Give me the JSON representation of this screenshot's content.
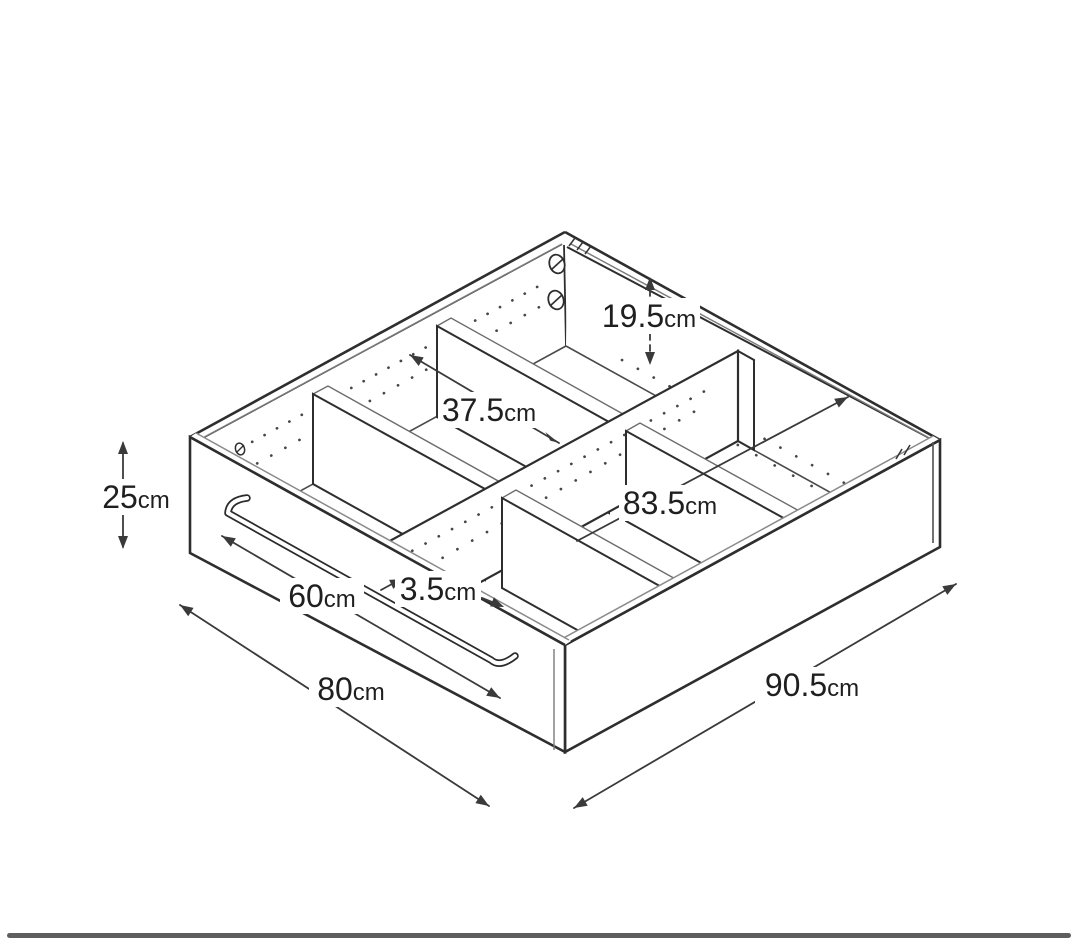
{
  "figure": {
    "type": "isometric line drawing",
    "subject": "drawer storage box with central divider, four cross dividers (six compartments), rod handle, screw fittings and shelf-pin hole rows",
    "line_color": "#2e2e2e",
    "secondary_line_color": "#8a8a8a",
    "dimension_color": "#3a3a3a",
    "dimensions": [
      {
        "id": "divider-height",
        "value": "19.5",
        "unit": "cm"
      },
      {
        "id": "compartment-width",
        "value": "37.5",
        "unit": "cm"
      },
      {
        "id": "interior-length",
        "value": "83.5",
        "unit": "cm"
      },
      {
        "id": "outer-height",
        "value": "25",
        "unit": "cm"
      },
      {
        "id": "handle-width",
        "value": "60",
        "unit": "cm"
      },
      {
        "id": "divider-thickness",
        "value": "3.5",
        "unit": "cm"
      },
      {
        "id": "front-edge-width",
        "value": "80",
        "unit": "cm"
      },
      {
        "id": "side-edge-depth",
        "value": "90.5",
        "unit": "cm"
      }
    ],
    "icons": [
      "screw-icon",
      "drawer-handle",
      "shelf-pin-holes"
    ]
  },
  "bottom_bar": {
    "color": "#5e5e5e"
  }
}
